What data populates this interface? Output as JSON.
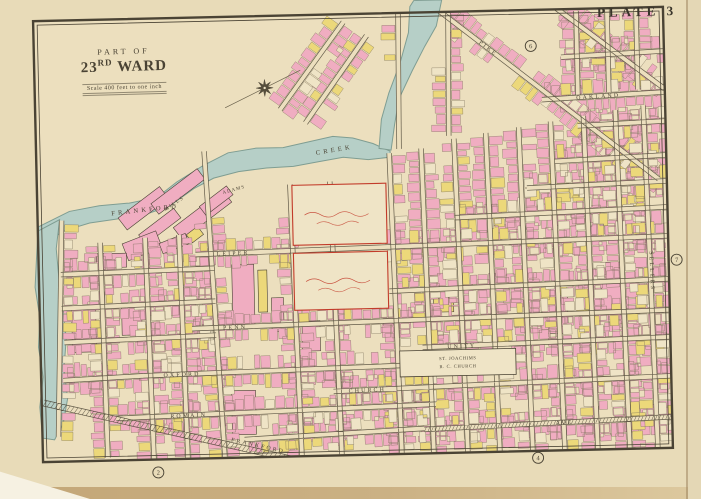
{
  "page": {
    "plate_label": "PLATE 3"
  },
  "title": {
    "line1": "PART OF",
    "ward_number": "23",
    "ward_suffix": "RD",
    "ward_word": "WARD",
    "scale": "Scale 400 feet to one inch"
  },
  "map": {
    "colors": {
      "paper": "#e8dbb8",
      "mapPaper": "#ecdfbe",
      "ink": "#4a4334",
      "inkSoft": "#6a614c",
      "pink": "#f0adc1",
      "yellow": "#ecd87a",
      "cream": "#efe4c6",
      "water": "#b6cfc7",
      "waterEdge": "#7f9d92",
      "red": "#c23b2a",
      "houseStroke": "#7a6f58"
    },
    "water": {
      "polys": [
        [
          [
            38,
            220
          ],
          [
            70,
            205
          ],
          [
            100,
            200
          ],
          [
            130,
            198
          ],
          [
            158,
            193
          ],
          [
            178,
            178
          ],
          [
            205,
            162
          ],
          [
            230,
            150
          ],
          [
            258,
            146
          ],
          [
            285,
            146
          ],
          [
            310,
            141
          ],
          [
            335,
            136
          ],
          [
            355,
            138
          ],
          [
            375,
            144
          ],
          [
            392,
            152
          ],
          [
            392,
            158
          ],
          [
            370,
            160
          ],
          [
            345,
            157
          ],
          [
            320,
            161
          ],
          [
            295,
            165
          ],
          [
            268,
            166
          ],
          [
            240,
            169
          ],
          [
            215,
            175
          ],
          [
            195,
            185
          ],
          [
            170,
            202
          ],
          [
            145,
            210
          ],
          [
            115,
            214
          ],
          [
            90,
            217
          ],
          [
            65,
            224
          ],
          [
            38,
            240
          ]
        ],
        [
          [
            419,
            2
          ],
          [
            447,
            2
          ],
          [
            441,
            28
          ],
          [
            429,
            48
          ],
          [
            416,
            72
          ],
          [
            402,
            100
          ],
          [
            397,
            126
          ],
          [
            393,
            151
          ],
          [
            381,
            149
          ],
          [
            384,
            120
          ],
          [
            392,
            94
          ],
          [
            404,
            64
          ],
          [
            413,
            34
          ],
          [
            415,
            8
          ]
        ],
        [
          [
            38,
            224
          ],
          [
            60,
            213
          ],
          [
            56,
            242
          ],
          [
            58,
            272
          ],
          [
            61,
            302
          ],
          [
            64,
            332
          ],
          [
            61,
            362
          ],
          [
            64,
            392
          ],
          [
            59,
            417
          ],
          [
            50,
            433
          ],
          [
            38,
            431
          ],
          [
            36,
            400
          ],
          [
            40,
            370
          ],
          [
            36,
            340
          ],
          [
            38,
            310
          ],
          [
            34,
            280
          ],
          [
            36,
            252
          ]
        ]
      ],
      "labels": [
        {
          "t": "FRANKFORD",
          "x": 112,
          "y": 210,
          "r": -5,
          "s": 6.5,
          "ls": 3.2
        },
        {
          "t": "CREEK",
          "x": 318,
          "y": 154,
          "r": -8,
          "s": 6.5,
          "ls": 3.2
        }
      ]
    },
    "streets": [
      {
        "x1": 545,
        "y1": 104,
        "x2": 668,
        "y2": 99,
        "n": "OAKLAND",
        "lt": 0.28
      },
      {
        "x1": 580,
        "y1": 131,
        "x2": 668,
        "y2": 128
      },
      {
        "x1": 556,
        "y1": 166,
        "x2": 668,
        "y2": 162
      },
      {
        "x1": 528,
        "y1": 192,
        "x2": 668,
        "y2": 188
      },
      {
        "x1": 455,
        "y1": 220,
        "x2": 668,
        "y2": 214
      },
      {
        "x1": 195,
        "y1": 251,
        "x2": 668,
        "y2": 243,
        "n": "LEIPER",
        "lt": 0.045
      },
      {
        "x1": 388,
        "y1": 292,
        "x2": 668,
        "y2": 286
      },
      {
        "x1": 60,
        "y1": 268,
        "x2": 214,
        "y2": 265
      },
      {
        "x1": 60,
        "y1": 302,
        "x2": 214,
        "y2": 298
      },
      {
        "x1": 62,
        "y1": 336,
        "x2": 214,
        "y2": 332
      },
      {
        "x1": 60,
        "y1": 374,
        "x2": 140,
        "y2": 371
      },
      {
        "x1": 190,
        "y1": 325,
        "x2": 668,
        "y2": 317,
        "n": "PENN",
        "lt": 0.065
      },
      {
        "x1": 420,
        "y1": 349,
        "x2": 668,
        "y2": 344,
        "n": "UNITY",
        "lt": 0.1
      },
      {
        "x1": 140,
        "y1": 371,
        "x2": 432,
        "y2": 366,
        "n": "OXFORD",
        "lt": 0.07
      },
      {
        "x1": 330,
        "y1": 391,
        "x2": 668,
        "y2": 383,
        "n": "CHURCH",
        "lt": 0.045
      },
      {
        "x1": 112,
        "y1": 413,
        "x2": 432,
        "y2": 406,
        "n": "ROMAIN",
        "lt": 0.17
      },
      {
        "x1": 420,
        "y1": 431,
        "x2": 668,
        "y2": 424,
        "n": "AVE",
        "lt": 0.53,
        "k": "tram"
      },
      {
        "x1": 240,
        "y1": 437,
        "x2": 420,
        "y2": 430
      },
      {
        "x1": 100,
        "y1": 237,
        "x2": 103,
        "y2": 452
      },
      {
        "x1": 145,
        "y1": 233,
        "x2": 149,
        "y2": 454
      },
      {
        "x1": 179,
        "y1": 231,
        "x2": 183,
        "y2": 455
      },
      {
        "x1": 206,
        "y1": 148,
        "x2": 220,
        "y2": 455
      },
      {
        "x1": 291,
        "y1": 183,
        "x2": 297,
        "y2": 455
      },
      {
        "x1": 331,
        "y1": 181,
        "x2": 337,
        "y2": 455
      },
      {
        "x1": 391,
        "y1": 154,
        "x2": 397,
        "y2": 455
      },
      {
        "x1": 423,
        "y1": 150,
        "x2": 429,
        "y2": 455
      },
      {
        "x1": 456,
        "y1": 141,
        "x2": 463,
        "y2": 455
      },
      {
        "x1": 488,
        "y1": 136,
        "x2": 495,
        "y2": 455
      },
      {
        "x1": 521,
        "y1": 131,
        "x2": 528,
        "y2": 455
      },
      {
        "x1": 553,
        "y1": 126,
        "x2": 560,
        "y2": 455
      },
      {
        "x1": 586,
        "y1": 121,
        "x2": 593,
        "y2": 455
      },
      {
        "x1": 618,
        "y1": 116,
        "x2": 625,
        "y2": 455
      },
      {
        "x1": 646,
        "y1": 112,
        "x2": 653,
        "y2": 455,
        "n": "SELLERS",
        "lt": 0.42,
        "v": true
      },
      {
        "x1": 403,
        "y1": 14,
        "x2": 401,
        "y2": 150
      },
      {
        "x1": 453,
        "y1": 14,
        "x2": 451,
        "y2": 138
      },
      {
        "x1": 581,
        "y1": 16,
        "x2": 581,
        "y2": 100
      },
      {
        "x1": 612,
        "y1": 15,
        "x2": 612,
        "y2": 98
      },
      {
        "x1": 641,
        "y1": 14,
        "x2": 641,
        "y2": 96
      },
      {
        "x1": 62,
        "y1": 214,
        "x2": 54,
        "y2": 430,
        "hs": -1
      },
      {
        "x1": 433,
        "y1": 4,
        "x2": 660,
        "y2": 186,
        "n": "PIKE",
        "lt": 0.22
      },
      {
        "x1": 560,
        "y1": 12,
        "x2": 668,
        "y2": 96
      },
      {
        "x1": 371,
        "y1": 36,
        "x2": 308,
        "y2": 122
      },
      {
        "x1": 348,
        "y1": 22,
        "x2": 283,
        "y2": 108
      },
      {
        "x1": 565,
        "y1": 62,
        "x2": 668,
        "y2": 58
      },
      {
        "x1": 40,
        "y1": 396,
        "x2": 348,
        "y2": 473,
        "k": "rail",
        "n": "FRANKFORD",
        "lt": 0.6
      }
    ],
    "exclusions": [
      [
        296,
        185,
        92,
        124
      ],
      [
        397,
        351,
        118,
        28
      ],
      [
        38,
        138,
        357,
        78
      ],
      [
        405,
        2,
        48,
        60
      ],
      [
        385,
        60,
        30,
        95
      ],
      [
        44,
        18,
        235,
        128
      ]
    ],
    "factories": [
      {
        "x": 118,
        "y": 196,
        "w": 52,
        "h": 15,
        "r": -36,
        "f": "p"
      },
      {
        "x": 150,
        "y": 181,
        "w": 58,
        "h": 13,
        "r": -36,
        "f": "p"
      },
      {
        "x": 172,
        "y": 204,
        "w": 62,
        "h": 15,
        "r": -36,
        "f": "p"
      },
      {
        "x": 138,
        "y": 216,
        "w": 44,
        "h": 12,
        "r": -36,
        "f": "p"
      },
      {
        "x": 200,
        "y": 192,
        "w": 34,
        "h": 11,
        "r": -36,
        "f": "p"
      },
      {
        "x": 124,
        "y": 232,
        "w": 36,
        "h": 18,
        "r": -20,
        "f": "p"
      },
      {
        "x": 188,
        "y": 226,
        "w": 14,
        "h": 10,
        "r": -36,
        "f": "y"
      },
      {
        "x": 160,
        "y": 234,
        "w": 28,
        "h": 11,
        "r": -20,
        "f": "p"
      },
      {
        "x": 231,
        "y": 262,
        "w": 22,
        "h": 60,
        "f": "p"
      },
      {
        "x": 257,
        "y": 268,
        "w": 9,
        "h": 42,
        "f": "y"
      },
      {
        "x": 270,
        "y": 296,
        "w": 12,
        "h": 34,
        "f": "p"
      },
      {
        "x": 228,
        "y": 388,
        "w": 24,
        "h": 44,
        "f": "p"
      },
      {
        "x": 300,
        "y": 320,
        "w": 18,
        "h": 30,
        "f": "p"
      },
      {
        "x": 432,
        "y": 300,
        "w": 20,
        "h": 14,
        "f": "y"
      },
      {
        "x": 540,
        "y": 298,
        "w": 26,
        "h": 40,
        "f": "p"
      },
      {
        "x": 600,
        "y": 268,
        "w": 22,
        "h": 48,
        "f": "p"
      },
      {
        "x": 96,
        "y": 248,
        "w": 30,
        "h": 14,
        "f": "p"
      },
      {
        "x": 70,
        "y": 300,
        "w": 24,
        "h": 46,
        "f": "p"
      },
      {
        "x": 120,
        "y": 300,
        "w": 20,
        "h": 30,
        "f": "p"
      }
    ],
    "estates": [
      {
        "x": 293,
        "y": 184,
        "w": 94,
        "h": 60
      },
      {
        "x": 293,
        "y": 252,
        "w": 94,
        "h": 57
      }
    ],
    "church": {
      "x": 397,
      "y": 352,
      "w": 116,
      "h": 26,
      "lines": [
        "ST. JOACHIMS",
        "R. C. CHURCH"
      ]
    },
    "labels": [
      {
        "t": "ADAMS",
        "x": 224,
        "y": 191,
        "r": -14,
        "s": 4.8,
        "ls": 1.2
      },
      {
        "t": "MILLS",
        "x": 166,
        "y": 207,
        "r": -33,
        "s": 5.2,
        "ls": 1.5
      }
    ],
    "plate_refs": [
      {
        "t": "6",
        "x": 535,
        "y": 50
      },
      {
        "t": "7",
        "x": 676,
        "y": 267
      },
      {
        "t": "2",
        "x": 153,
        "y": 468
      },
      {
        "t": "4",
        "x": 533,
        "y": 462
      }
    ],
    "compass": {
      "x": 268,
      "y": 86
    }
  }
}
